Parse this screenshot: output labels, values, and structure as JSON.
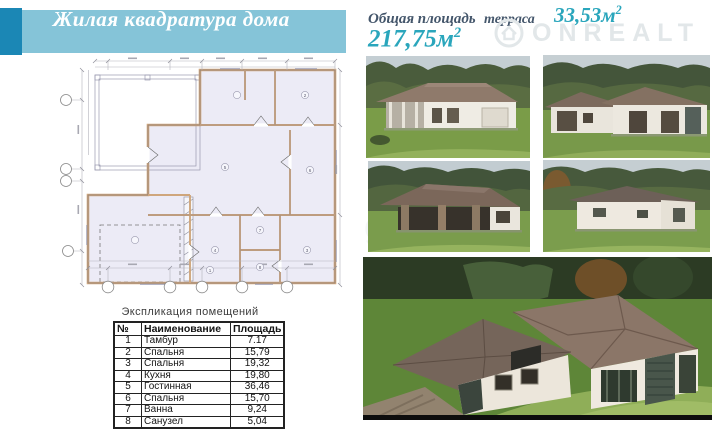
{
  "colors": {
    "banner_bg": "#85c4d8",
    "banner_accent": "#1b87b5",
    "accent_teal": "#2aa6bc",
    "label_dark": "#44566b"
  },
  "banner": {
    "title": "Жилая квадратура дома"
  },
  "area_header": {
    "total_label": "Общая площадь",
    "terrace_label": "терраса",
    "terrace_value": "33,53м",
    "terrace_sup": "2",
    "total_value": "217,75м",
    "total_sup": "2"
  },
  "watermark": {
    "brand": "ONREALT",
    "fragment": "gi"
  },
  "plan": {
    "room_tags": [
      "1",
      "2",
      "3",
      "4",
      "5",
      "6",
      "7",
      "8"
    ]
  },
  "table": {
    "title": "Экспликация помещений",
    "headers": [
      "№",
      "Наименование",
      "Площадь"
    ],
    "rows": [
      [
        "1",
        "Тамбур",
        "7.17"
      ],
      [
        "2",
        "Спальня",
        "15,79"
      ],
      [
        "3",
        "Спальня",
        "19,32"
      ],
      [
        "4",
        "Кухня",
        "19,80"
      ],
      [
        "5",
        "Гостинная",
        "36,46"
      ],
      [
        "6",
        "Спальня",
        "15,70"
      ],
      [
        "7",
        "Ванна",
        "9,24"
      ],
      [
        "8",
        "Санузел",
        "5,04"
      ]
    ]
  }
}
